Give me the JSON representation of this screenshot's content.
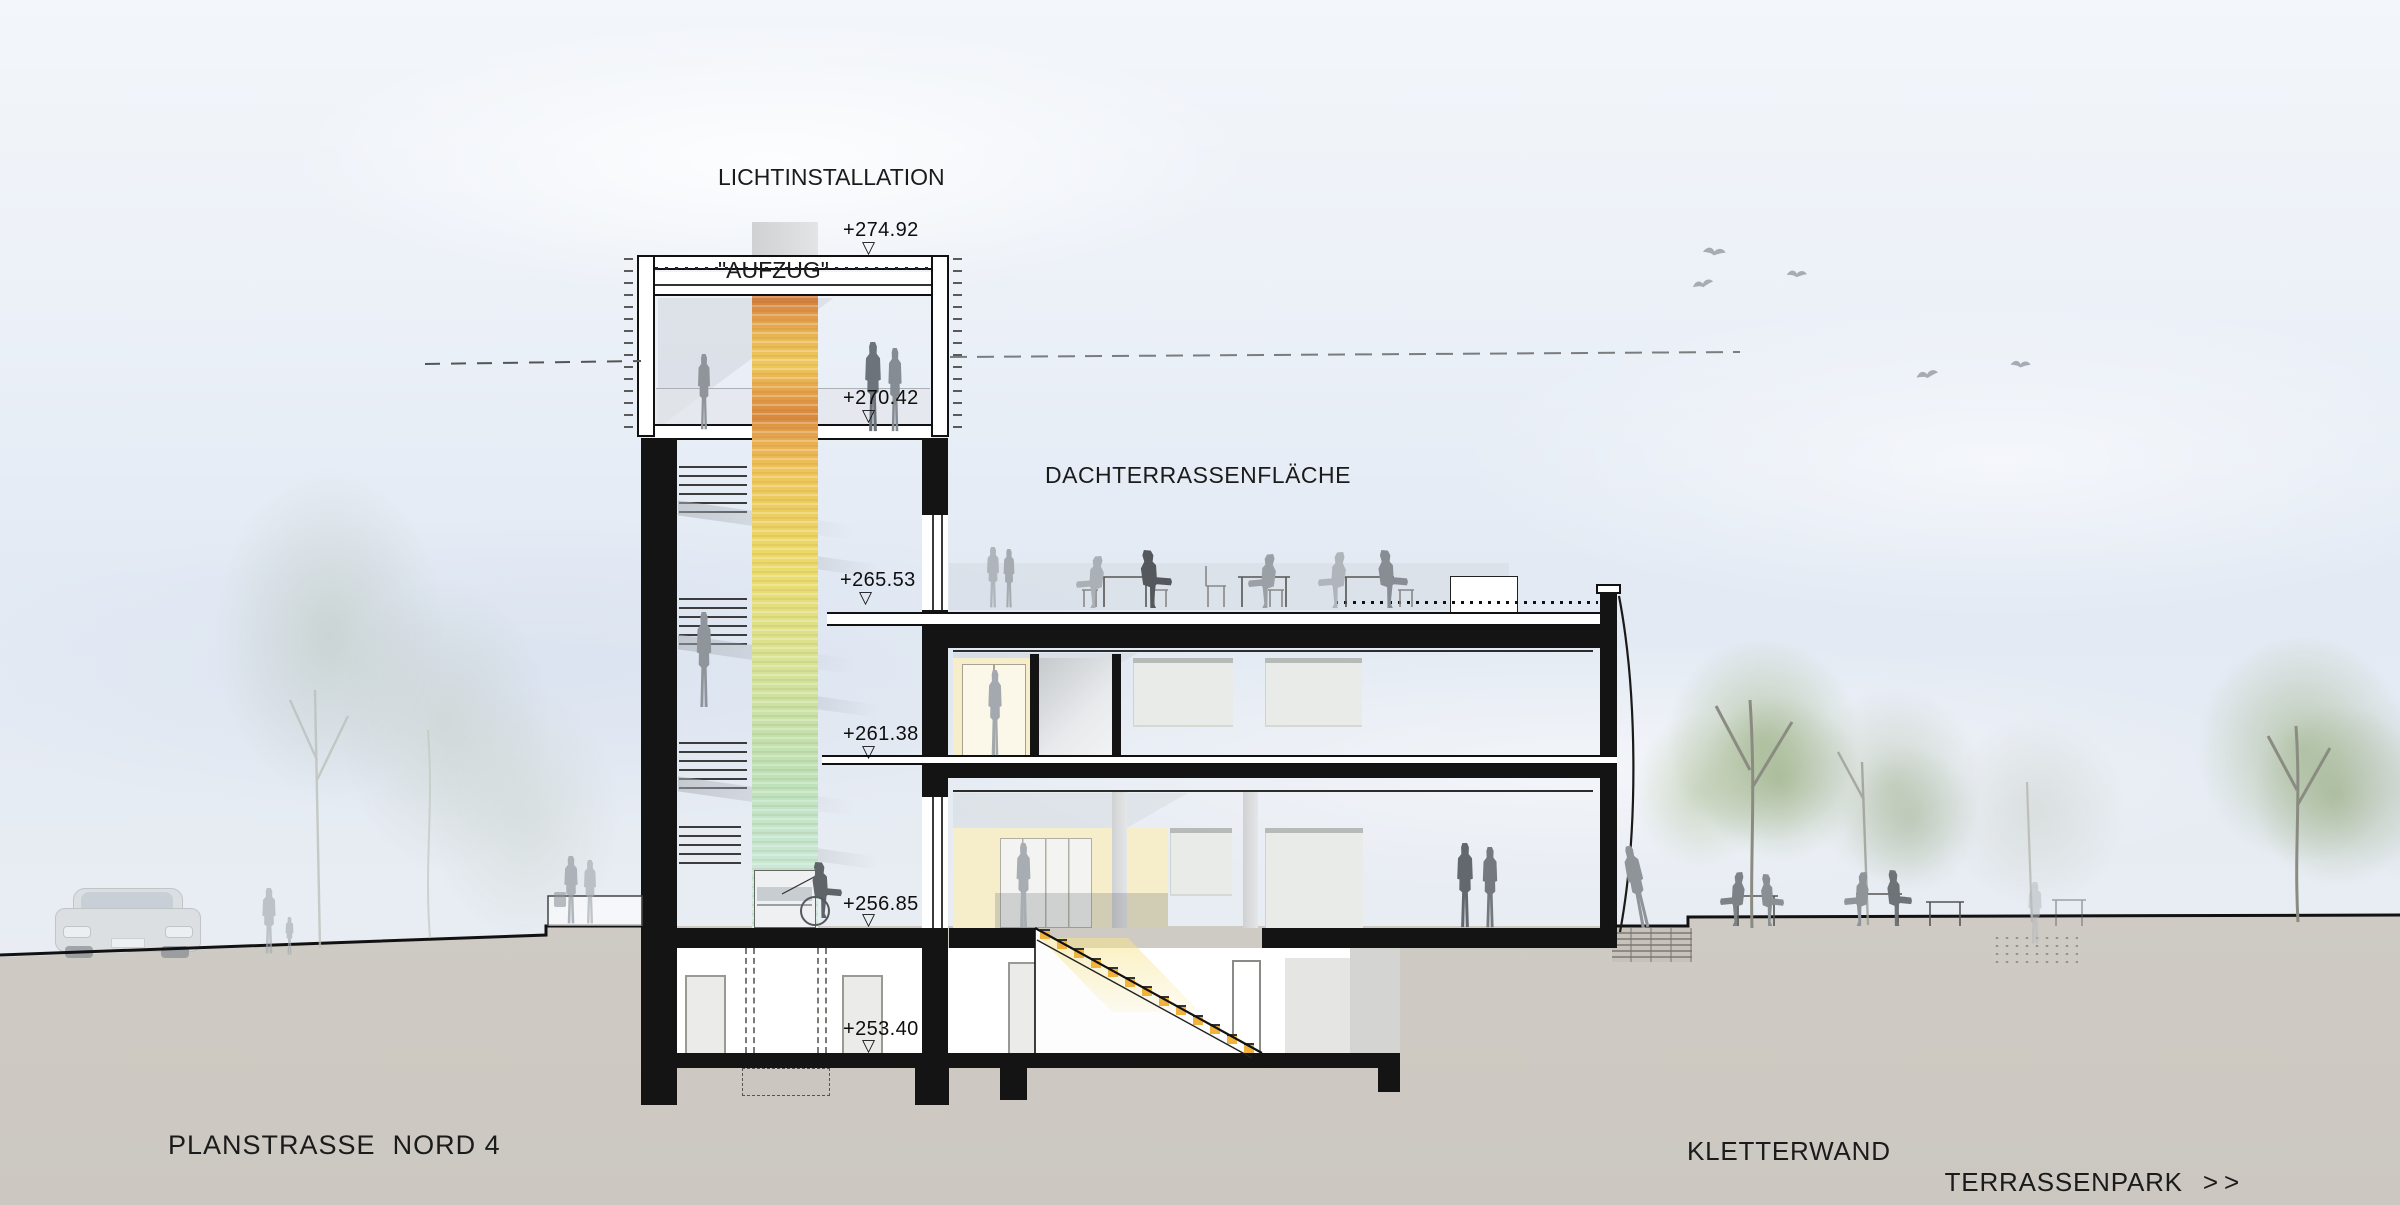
{
  "annotations": {
    "light_installation_line1": "LICHTINSTALLATION",
    "light_installation_line2": "\"AUFZUG\"",
    "roof_terrace": "DACHTERRASSENFLÄCHE"
  },
  "elevation_symbol": "▽",
  "elevation_markers": [
    {
      "id": "tower_roof",
      "label": "+274.92"
    },
    {
      "id": "observation_deck",
      "label": "+270.42"
    },
    {
      "id": "roof_terrace",
      "label": "+265.53"
    },
    {
      "id": "upper_floor",
      "label": "+261.38"
    },
    {
      "id": "ground_floor",
      "label": "+256.85"
    },
    {
      "id": "basement",
      "label": "+253.40"
    }
  ],
  "ground_labels": {
    "street": "PLANSTRASSE  NORD 4",
    "climbing_wall": "KLETTERWAND",
    "terrace_park": "TERRASSENPARK",
    "terrace_park_arrows": ">>"
  },
  "colors": {
    "shaft_top": "#cf7a3e",
    "shaft_middle": "#e9dc70",
    "shaft_bottom": "#d3ebe0",
    "step_accent": "#f2b23e",
    "ground": "#d5d1ca"
  }
}
